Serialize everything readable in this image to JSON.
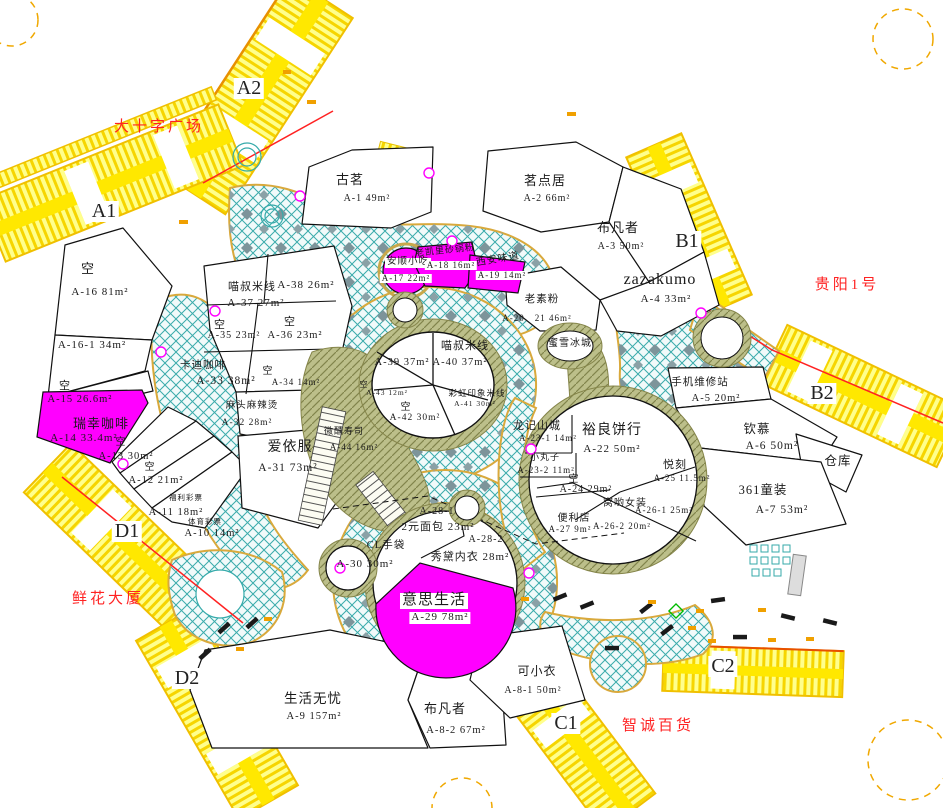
{
  "colors": {
    "corridor_yellow": "#ffee00",
    "walkway_teal": "#3aabab",
    "highlight_magenta": "#ff00ff",
    "landmark_red": "#ff2222",
    "tan_hatch": "#bcbf8a"
  },
  "landmarks": [
    {
      "t": "大十字广场",
      "x": 159,
      "y": 120
    },
    {
      "t": "贵阳1号",
      "x": 847,
      "y": 278
    },
    {
      "t": "鲜花大厦",
      "x": 108,
      "y": 592
    },
    {
      "t": "智诚百货",
      "x": 658,
      "y": 719
    }
  ],
  "corridor_labels": [
    {
      "t": "A2",
      "x": 249,
      "y": 78
    },
    {
      "t": "A1",
      "x": 104,
      "y": 201
    },
    {
      "t": "B1",
      "x": 687,
      "y": 231
    },
    {
      "t": "B2",
      "x": 822,
      "y": 383
    },
    {
      "t": "C1",
      "x": 566,
      "y": 713
    },
    {
      "t": "C2",
      "x": 723,
      "y": 656
    },
    {
      "t": "D1",
      "x": 127,
      "y": 521
    },
    {
      "t": "D2",
      "x": 187,
      "y": 668
    }
  ],
  "units": [
    {
      "name": "古茗",
      "code": "A-1",
      "area": "49m²",
      "labels": [
        {
          "t": "古茗",
          "x": 350,
          "y": 173,
          "s": 13
        },
        {
          "t": "A-1 49m²",
          "x": 367,
          "y": 194,
          "s": 10
        }
      ]
    },
    {
      "name": "茗点居",
      "code": "A-2",
      "area": "66m²",
      "labels": [
        {
          "t": "茗点居",
          "x": 545,
          "y": 174,
          "s": 13
        },
        {
          "t": "A-2 66m²",
          "x": 547,
          "y": 194,
          "s": 10
        }
      ]
    },
    {
      "name": "布凡者",
      "code": "A-3",
      "area": "50m²",
      "labels": [
        {
          "t": "布凡者",
          "x": 618,
          "y": 221,
          "s": 13
        },
        {
          "t": "A-3 50m²",
          "x": 621,
          "y": 242,
          "s": 10
        }
      ]
    },
    {
      "name": "zazakumo",
      "code": "A-4",
      "area": "33m²",
      "labels": [
        {
          "t": "zazakumo",
          "x": 660,
          "y": 272,
          "s": 16
        },
        {
          "t": "A-4 33m²",
          "x": 666,
          "y": 294,
          "s": 11
        }
      ]
    },
    {
      "name": "老素粉",
      "code": "A-20、21",
      "area": "46m²",
      "labels": [
        {
          "t": "老素粉",
          "x": 542,
          "y": 294,
          "s": 10.5
        },
        {
          "t": "A-20、21 46m²",
          "x": 537,
          "y": 314,
          "s": 9
        }
      ]
    },
    {
      "name": "蜜雪冰城",
      "labels": [
        {
          "t": "蜜雪冰城",
          "x": 570,
          "y": 339,
          "s": 10
        }
      ]
    },
    {
      "name": "手机维修站",
      "code": "A-5",
      "area": "20m²",
      "labels": [
        {
          "t": "手机维修站",
          "x": 700,
          "y": 377,
          "s": 10.5
        },
        {
          "t": "A-5 20m²",
          "x": 716,
          "y": 393,
          "s": 10.5
        }
      ]
    },
    {
      "name": "钦慕",
      "code": "A-6",
      "area": "50m²",
      "labels": [
        {
          "t": "钦慕",
          "x": 757,
          "y": 423,
          "s": 12.5
        },
        {
          "t": "A-6 50m²",
          "x": 772,
          "y": 440,
          "s": 11.5
        }
      ]
    },
    {
      "name": "仓库",
      "labels": [
        {
          "t": "仓库",
          "x": 838,
          "y": 455,
          "s": 12.5
        }
      ]
    },
    {
      "name": "361童装",
      "code": "A-7",
      "area": "53m²",
      "labels": [
        {
          "t": "361童装",
          "x": 763,
          "y": 484,
          "s": 12.5
        },
        {
          "t": "A-7 53m²",
          "x": 782,
          "y": 504,
          "s": 11.5
        }
      ]
    },
    {
      "name": "空",
      "vacant": true,
      "code": "A-16",
      "area": "81m²",
      "labels": [
        {
          "t": "空",
          "x": 88,
          "y": 262,
          "s": 13
        },
        {
          "t": "A-16 81m²",
          "x": 100,
          "y": 287,
          "s": 11
        }
      ]
    },
    {
      "name": "空",
      "vacant": true,
      "code": "A-16-1",
      "area": "34m²",
      "labels": [
        {
          "t": "A-16-1 34m²",
          "x": 92,
          "y": 340,
          "s": 11
        }
      ]
    },
    {
      "name": "空",
      "vacant": true,
      "code": "A-15",
      "area": "26.6m²",
      "labels": [
        {
          "t": "空",
          "x": 65,
          "y": 381,
          "s": 11
        },
        {
          "t": "A-15 26.6m²",
          "x": 80,
          "y": 394,
          "s": 10.5
        }
      ]
    },
    {
      "name": "瑞幸咖啡",
      "code": "A-14",
      "area": "33.4m²",
      "highlight": true,
      "labels": [
        {
          "t": "瑞幸咖啡",
          "x": 101,
          "y": 417,
          "s": 13
        },
        {
          "t": "A-14 33.4m²",
          "x": 84,
          "y": 433,
          "s": 11
        }
      ]
    },
    {
      "name": "空",
      "vacant": true,
      "code": "A-13",
      "area": "30m²",
      "labels": [
        {
          "t": "空",
          "x": 121,
          "y": 438,
          "s": 10
        },
        {
          "t": "A-13 30m²",
          "x": 126,
          "y": 451,
          "s": 10.5
        }
      ]
    },
    {
      "name": "空",
      "vacant": true,
      "code": "A-12",
      "area": "21m²",
      "labels": [
        {
          "t": "空",
          "x": 150,
          "y": 463,
          "s": 10
        },
        {
          "t": "A-12 21m²",
          "x": 156,
          "y": 475,
          "s": 10.5
        }
      ]
    },
    {
      "name": "福利彩票",
      "code": "A-11",
      "area": "18m²",
      "labels": [
        {
          "t": "福利彩票",
          "x": 186,
          "y": 494,
          "s": 7.5
        },
        {
          "t": "A-11 18m²",
          "x": 176,
          "y": 507,
          "s": 10.5
        }
      ]
    },
    {
      "name": "体育彩票",
      "code": "A-10",
      "area": "14m²",
      "labels": [
        {
          "t": "体育彩票",
          "x": 205,
          "y": 518,
          "s": 7.5
        },
        {
          "t": "A-10 14m²",
          "x": 212,
          "y": 528,
          "s": 10.5
        }
      ]
    },
    {
      "name": "喵叔米线",
      "code": "A-37 / A-38",
      "area": "27m² / 26m²",
      "labels": [
        {
          "t": "喵叔米线",
          "x": 252,
          "y": 282,
          "s": 11
        },
        {
          "t": "A-37 27m²",
          "x": 256,
          "y": 298,
          "s": 11
        },
        {
          "t": "A-38 26m²",
          "x": 306,
          "y": 280,
          "s": 11
        }
      ]
    },
    {
      "name": "空",
      "vacant": true,
      "code": "A-35",
      "area": "23m²",
      "labels": [
        {
          "t": "空",
          "x": 220,
          "y": 320,
          "s": 11
        },
        {
          "t": "A-35 23m²",
          "x": 234,
          "y": 331,
          "s": 10
        }
      ]
    },
    {
      "name": "空",
      "vacant": true,
      "code": "A-36",
      "area": "23m²",
      "labels": [
        {
          "t": "空",
          "x": 290,
          "y": 317,
          "s": 11
        },
        {
          "t": "A-36 23m²",
          "x": 295,
          "y": 330,
          "s": 10.5
        }
      ]
    },
    {
      "name": "卡迪咖啡",
      "code": "A-33",
      "area": "38m²",
      "labels": [
        {
          "t": "卡迪咖啡",
          "x": 203,
          "y": 360,
          "s": 10.5
        },
        {
          "t": "A-33 38m²",
          "x": 226,
          "y": 375,
          "s": 11.5
        }
      ]
    },
    {
      "name": "空",
      "vacant": true,
      "code": "A-34",
      "area": "14m²",
      "labels": [
        {
          "t": "空",
          "x": 268,
          "y": 367,
          "s": 10
        },
        {
          "t": "A-34 14m²",
          "x": 296,
          "y": 378,
          "s": 9
        }
      ]
    },
    {
      "name": "麻头麻辣烫",
      "code": "A-32",
      "area": "28m²",
      "labels": [
        {
          "t": "麻头麻辣烫",
          "x": 252,
          "y": 402,
          "s": 9.5
        },
        {
          "t": "A-32 28m²",
          "x": 247,
          "y": 419,
          "s": 9.5
        }
      ]
    },
    {
      "name": "爱依服",
      "code": "A-31",
      "area": "73m²",
      "labels": [
        {
          "t": "爱依服",
          "x": 290,
          "y": 441,
          "s": 14
        },
        {
          "t": "A-31 73m²",
          "x": 288,
          "y": 462,
          "s": 11.5
        }
      ]
    },
    {
      "name": "微醺寿司",
      "code": "A-44",
      "area": "16m²",
      "labels": [
        {
          "t": "微醺寿司",
          "x": 344,
          "y": 427,
          "s": 9
        },
        {
          "t": "A-44 16m²",
          "x": 354,
          "y": 443,
          "s": 9
        }
      ]
    },
    {
      "name": "喵叔米线",
      "code": "A-39 / A-40",
      "area": "37m² / 37m²",
      "labels": [
        {
          "t": "喵叔米线",
          "x": 465,
          "y": 341,
          "s": 11
        },
        {
          "t": "A-39 37m²",
          "x": 402,
          "y": 357,
          "s": 10.5
        },
        {
          "t": "A-40 37m²",
          "x": 460,
          "y": 357,
          "s": 10.5
        }
      ]
    },
    {
      "name": "空",
      "vacant": true,
      "code": "A-43",
      "area": "12m²",
      "labels": [
        {
          "t": "空",
          "x": 364,
          "y": 381,
          "s": 8
        },
        {
          "t": "A-43 12m²",
          "x": 387,
          "y": 389,
          "s": 7.5
        }
      ]
    },
    {
      "name": "彩虹印象米线",
      "code": "A-41",
      "area": "30m²",
      "labels": [
        {
          "t": "彩虹印象米线",
          "x": 477,
          "y": 389,
          "s": 8.5
        },
        {
          "t": "A-41 30m²",
          "x": 475,
          "y": 400,
          "s": 7.5
        }
      ]
    },
    {
      "name": "空",
      "vacant": true,
      "code": "A-42",
      "area": "30m²",
      "labels": [
        {
          "t": "空",
          "x": 406,
          "y": 403,
          "s": 10
        },
        {
          "t": "A-42 30m²",
          "x": 415,
          "y": 414,
          "s": 9.5
        }
      ]
    },
    {
      "name": "安顺小吃",
      "code": "A-17",
      "area": "22m²",
      "highlight": true,
      "labels": [
        {
          "t": "安顺小吃",
          "x": 408,
          "y": 258,
          "s": 9.5,
          "box": true
        },
        {
          "t": "A-17 22m²",
          "x": 406,
          "y": 274,
          "s": 9,
          "box": true
        }
      ]
    },
    {
      "name": "老凯里砂锅粉",
      "code": "A-18",
      "area": "16m²",
      "highlight": true,
      "labels": [
        {
          "t": "老凯里砂锅粉",
          "x": 445,
          "y": 246,
          "s": 9,
          "r": -6
        },
        {
          "t": "A-18 16m²",
          "x": 451,
          "y": 261,
          "s": 9,
          "box": true
        }
      ]
    },
    {
      "name": "西安味道",
      "code": "A-19",
      "area": "14m²",
      "highlight": true,
      "labels": [
        {
          "t": "西安味道",
          "x": 498,
          "y": 255,
          "s": 10,
          "r": -10
        },
        {
          "t": "A-19 14m²",
          "x": 502,
          "y": 271,
          "s": 9,
          "box": true
        }
      ]
    },
    {
      "name": "龙记山城",
      "code": "A-23-1",
      "area": "14m²",
      "labels": [
        {
          "t": "龙记山城",
          "x": 537,
          "y": 421,
          "s": 11
        },
        {
          "t": "A-23-1 14m²",
          "x": 548,
          "y": 434,
          "s": 9
        }
      ]
    },
    {
      "name": "小丸子",
      "code": "A-23-2",
      "area": "11m²",
      "labels": [
        {
          "t": "小丸子",
          "x": 545,
          "y": 453,
          "s": 9
        },
        {
          "t": "A-23-2 11m²",
          "x": 546,
          "y": 466,
          "s": 9
        }
      ]
    },
    {
      "name": "裕良饼行",
      "code": "A-22",
      "area": "50m²",
      "labels": [
        {
          "t": "裕良饼行",
          "x": 612,
          "y": 424,
          "s": 14
        },
        {
          "t": "A-22 50m²",
          "x": 612,
          "y": 444,
          "s": 11
        }
      ]
    },
    {
      "name": "悦刻",
      "code": "A-25",
      "area": "11.5m²",
      "labels": [
        {
          "t": "悦刻",
          "x": 675,
          "y": 460,
          "s": 11
        },
        {
          "t": "A-25 11.5m²",
          "x": 682,
          "y": 474,
          "s": 9
        }
      ]
    },
    {
      "name": "空",
      "vacant": true,
      "code": "A-24",
      "area": "29m²",
      "labels": [
        {
          "t": "空",
          "x": 574,
          "y": 475,
          "s": 10
        },
        {
          "t": "A-24 29m²",
          "x": 586,
          "y": 485,
          "s": 10
        }
      ]
    },
    {
      "name": "窝哟女装",
      "code": "A-26-1 / A-26-2",
      "area": "25m² / 20m²",
      "labels": [
        {
          "t": "窝哟女装",
          "x": 625,
          "y": 499,
          "s": 10
        },
        {
          "t": "A-26-1 25m²",
          "x": 664,
          "y": 506,
          "s": 9
        },
        {
          "t": "A-26-2 20m²",
          "x": 622,
          "y": 522,
          "s": 9
        }
      ]
    },
    {
      "name": "便利店",
      "code": "A-27",
      "area": "9m²",
      "labels": [
        {
          "t": "便利店",
          "x": 574,
          "y": 514,
          "s": 10
        },
        {
          "t": "A-27 9m²",
          "x": 570,
          "y": 525,
          "s": 9
        }
      ]
    },
    {
      "name": "2元面包",
      "code": "A-28-1",
      "area": "23m²",
      "labels": [
        {
          "t": "A-28-1",
          "x": 437,
          "y": 507,
          "s": 10
        },
        {
          "t": "2元面包 23m²",
          "x": 438,
          "y": 522,
          "s": 11
        }
      ]
    },
    {
      "name": "秀黛内衣",
      "code": "A-28-2",
      "area": "28m²",
      "labels": [
        {
          "t": "A-28-2",
          "x": 486,
          "y": 535,
          "s": 10
        },
        {
          "t": "秀黛内衣 28m²",
          "x": 470,
          "y": 552,
          "s": 11
        }
      ]
    },
    {
      "name": "CL手袋",
      "code": "A-30",
      "area": "30m²",
      "labels": [
        {
          "t": "CL手袋",
          "x": 386,
          "y": 540,
          "s": 10.5
        },
        {
          "t": "A-30 30m²",
          "x": 365,
          "y": 559,
          "s": 11
        }
      ]
    },
    {
      "name": "意思生活",
      "code": "A-29",
      "area": "78m²",
      "highlight": true,
      "labels": [
        {
          "t": "意思生活",
          "x": 434,
          "y": 593,
          "s": 15,
          "box": true
        },
        {
          "t": "A-29 78m²",
          "x": 440,
          "y": 612,
          "s": 11,
          "box": true
        }
      ]
    },
    {
      "name": "可小衣",
      "code": "A-8-1",
      "area": "50m²",
      "labels": [
        {
          "t": "可小衣",
          "x": 537,
          "y": 665,
          "s": 12
        },
        {
          "t": "A-8-1 50m²",
          "x": 533,
          "y": 686,
          "s": 10
        }
      ]
    },
    {
      "name": "生活无忧",
      "code": "A-9",
      "area": "157m²",
      "labels": [
        {
          "t": "生活无忧",
          "x": 313,
          "y": 692,
          "s": 13.5
        },
        {
          "t": "A-9 157m²",
          "x": 314,
          "y": 711,
          "s": 10.5
        }
      ]
    },
    {
      "name": "布凡者",
      "code": "A-8-2",
      "area": "67m²",
      "labels": [
        {
          "t": "布凡者",
          "x": 445,
          "y": 702,
          "s": 13
        },
        {
          "t": "A-8-2 67m²",
          "x": 456,
          "y": 725,
          "s": 10.5
        }
      ]
    }
  ]
}
